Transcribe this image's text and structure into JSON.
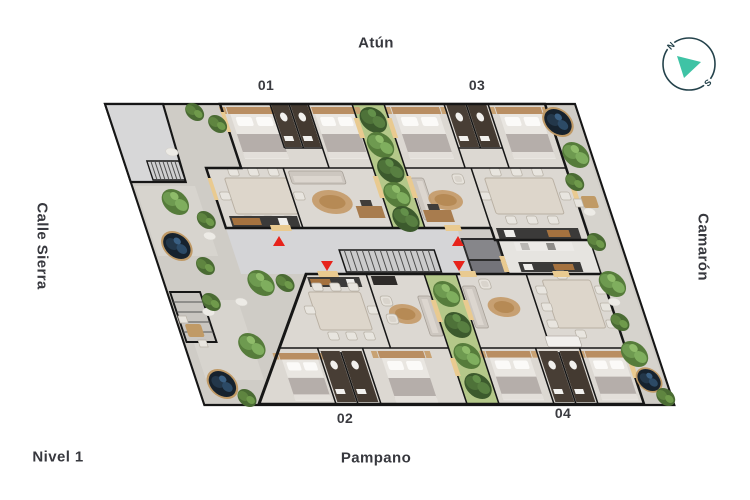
{
  "plan": {
    "level_label": "Nivel 1",
    "streets": {
      "top": "Atún",
      "bottom": "Pampano",
      "left": "Calle Sierra",
      "right": "Camarón"
    },
    "units": {
      "u01": "01",
      "u02": "02",
      "u03": "03",
      "u04": "04"
    },
    "compass": {
      "north": "N",
      "south": "S"
    },
    "colors": {
      "entry_marker_red": "#e7231b",
      "grass_green": "#b4c889",
      "compass_teal": "#3fc3a5",
      "wall_black": "#161616",
      "corridor_gray": "#d5d5d7",
      "outdoor_gray": "#cfccc6",
      "planter_foliage_navy": "#16222e",
      "wood_tan": "#c09a66"
    }
  }
}
